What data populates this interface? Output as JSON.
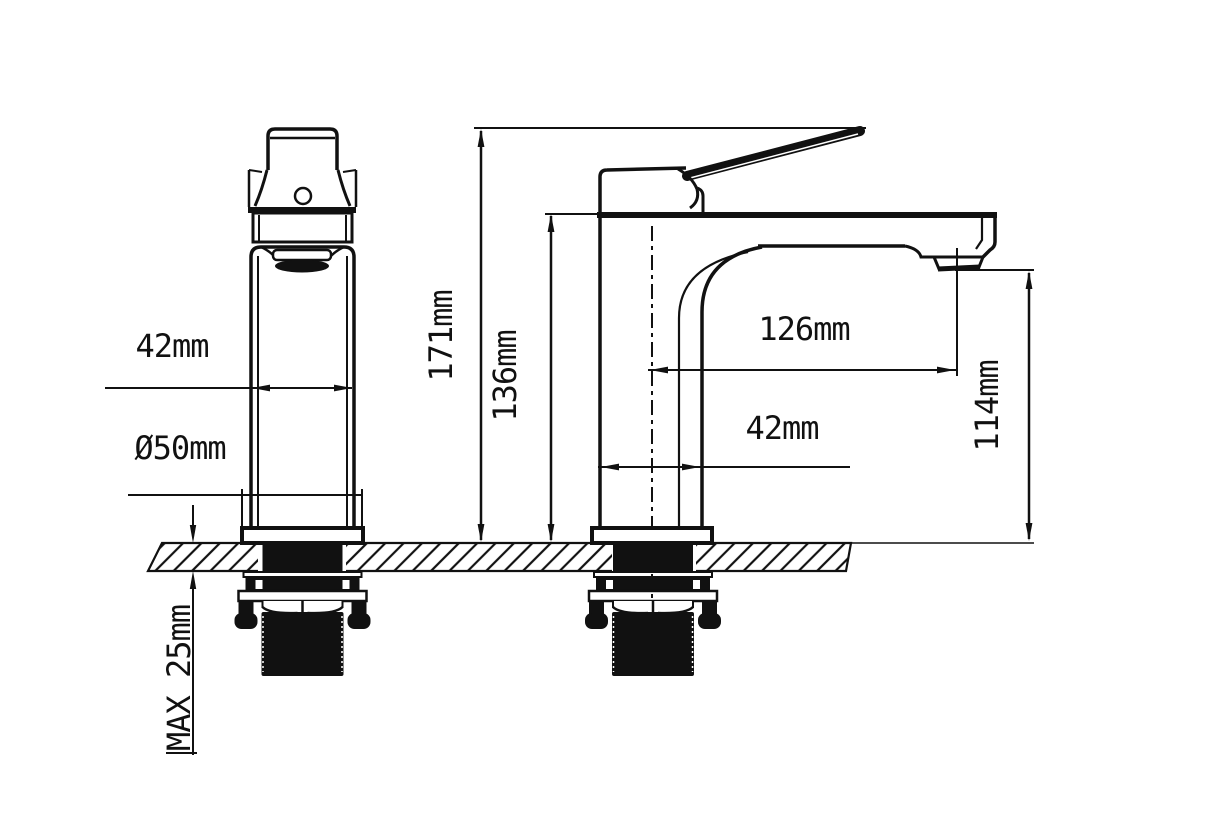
{
  "meta": {
    "background": "#ffffff",
    "line_color": "#111111",
    "canvas_border": "#d9d9d9",
    "drawing_type": "faucet installation dimension drawing, front and side views"
  },
  "dimensions": {
    "front_body_width": {
      "text": "42mm"
    },
    "front_base_diameter": {
      "text": "Ø50mm"
    },
    "overall_height": {
      "text": "171mm"
    },
    "height_to_spout_top": {
      "text": "136mm"
    },
    "spout_reach": {
      "text": "126mm"
    },
    "body_depth": {
      "text": "42mm"
    },
    "spout_outlet_height": {
      "text": "114mm"
    },
    "max_mounting_thickness": {
      "text": "MAX 25mm"
    }
  }
}
